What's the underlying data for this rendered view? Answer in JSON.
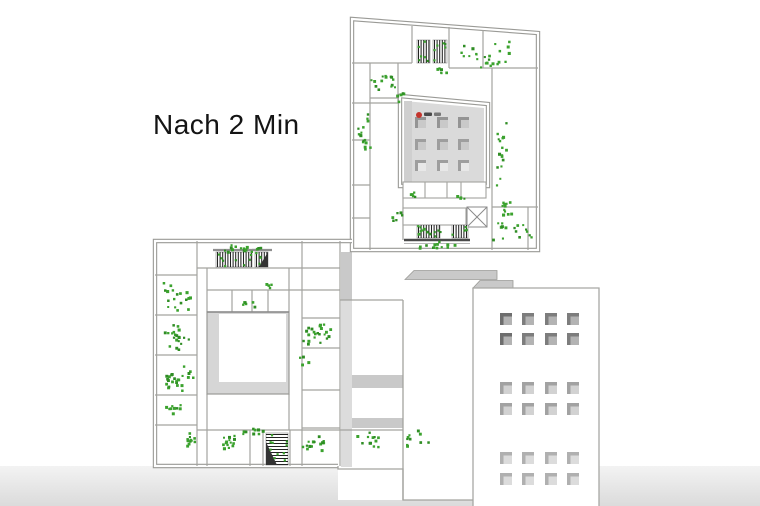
{
  "title": {
    "text": "Nach 2 Min"
  },
  "canvas": {
    "width": 760,
    "height": 506
  },
  "colors": {
    "wall": "#9a9a96",
    "wall_thin": "#a3a39f",
    "people_green": "#3ba22e",
    "people_green_dark": "#2f8d24",
    "stair_dark": "#222222",
    "roof_fill": "#dadada",
    "roof_edge": "#cfcfcf",
    "courtyard_gray": "#d6d6d6",
    "parapet": "#c9c9c9",
    "band": "#dcdcdc",
    "ground_top": "#f3f3f3",
    "ground_bottom": "#dbdbdb",
    "tower_stroke": "#a8a8a4",
    "logo_red": "#c4342c",
    "text": "#141414"
  },
  "ground": {
    "y": 466,
    "h": 40
  },
  "plan": {
    "exterior_double_walls": [
      "M352,19 L538,33 L538,250 L352,250 Z",
      "M352,241 L155,241 L155,466 L338,466"
    ],
    "exterior_single_paths": [
      "M338,466 L338,469 L403,469 L403,500 L473,500",
      "M340,300 L403,300",
      "M403,300 L403,500",
      "M340,430 L403,430"
    ],
    "white_fills": [
      {
        "x": 352,
        "y": 252,
        "w": 145,
        "h": 48
      },
      {
        "x": 352,
        "y": 300,
        "w": 51,
        "h": 167
      },
      {
        "x": 403,
        "y": 300,
        "w": 70,
        "h": 200
      },
      {
        "x": 338,
        "y": 466,
        "w": 65,
        "h": 34
      }
    ],
    "shade_bands": [
      {
        "x": 341,
        "y": 252,
        "w": 11,
        "h": 48,
        "tone": "parapet"
      },
      {
        "x": 341,
        "y": 300,
        "w": 11,
        "h": 167,
        "tone": "band"
      },
      {
        "x": 352,
        "y": 375,
        "w": 51,
        "h": 13,
        "tone": "parapet"
      },
      {
        "x": 352,
        "y": 418,
        "w": 51,
        "h": 10,
        "tone": "parapet"
      }
    ],
    "parapets": [
      "405,279.5 414,270.5 497,270.5 497,279.5",
      "473,288 480,280.5 513,280.5 513,288"
    ],
    "interior_walls": [
      "M352,63 H412",
      "M412,26 V63",
      "M449,27 V68",
      "M449,68 H538",
      "M483,30 V68",
      "M352,103 H398",
      "M398,63 V103",
      "M370,63 V250",
      "M352,140 H370",
      "M352,185 H370",
      "M352,218 H370",
      "M370,98 H400",
      "M492,68 V250",
      "M492,207 H538",
      "M528,207 V250",
      "M403,182 V240",
      "M197,241 V466",
      "M155,275 H197",
      "M155,315 H197",
      "M155,355 H197",
      "M155,395 H197",
      "M155,425 H197",
      "M197,268 H340",
      "M207,290 H340",
      "M207,268 V312",
      "M232,290 V312",
      "M252,290 V312",
      "M268,290 V312",
      "M289,268 V312",
      "M302,241 V466",
      "M340,241 V466",
      "M302,318 H340",
      "M302,348 H340",
      "M302,390 H340",
      "M302,428 H340",
      "M207,394 V466",
      "M289,394 V430",
      "M197,430 H340",
      "M250,430 V466",
      "M263,430 V466",
      "M290,430 V466"
    ]
  },
  "courtyard": {
    "x": 207,
    "y": 312,
    "w": 82,
    "h": 82,
    "inner": {
      "x": 219,
      "y": 314,
      "w": 67,
      "h": 68
    },
    "dark_top_line": {
      "x1": 207,
      "y1": 312,
      "x2": 289,
      "y2": 312
    }
  },
  "roof_block": {
    "outer_points": "400,96 488,104 488,186 400,186",
    "roof_points": "404,101 484,108 484,182 404,182",
    "edge_band": {
      "x": 404,
      "y": 101,
      "w": 8,
      "h": 81
    },
    "skylights": {
      "cols": [
        415,
        437,
        458
      ],
      "rows": [
        117,
        139,
        160
      ],
      "size": 11,
      "inner_offset": 3,
      "inner_size": 8
    }
  },
  "cells": [
    {
      "x": 403,
      "y": 182,
      "w": 83,
      "h": 16,
      "dividers_x": [
        425,
        447,
        461
      ]
    },
    {
      "x": 403,
      "y": 208,
      "w": 63,
      "h": 17,
      "dividers_x": []
    }
  ],
  "x_box": {
    "x": 467,
    "y": 207,
    "w": 20,
    "h": 20
  },
  "stairs": [
    {
      "x": 417,
      "y": 40,
      "w": 13,
      "h": 23,
      "o": "v",
      "g": 6
    },
    {
      "x": 433,
      "y": 40,
      "w": 14,
      "h": 23,
      "o": "v",
      "g": 6
    },
    {
      "x": 417,
      "y": 225,
      "w": 23,
      "h": 13,
      "o": "v",
      "g": 5
    },
    {
      "x": 452,
      "y": 225,
      "w": 16,
      "h": 13,
      "o": "v",
      "g": 4
    },
    {
      "x": 216,
      "y": 252,
      "w": 36,
      "h": 15,
      "o": "v",
      "g": 8,
      "cap": true
    },
    {
      "x": 255,
      "y": 252,
      "w": 13,
      "h": 15,
      "o": "v",
      "g": 3,
      "cap": true,
      "wedge": "r"
    },
    {
      "x": 266,
      "y": 433,
      "w": 22,
      "h": 32,
      "o": "h",
      "g": 10,
      "wedge": "l"
    }
  ],
  "stair_underlines": [
    {
      "x1": 404,
      "y1": 240,
      "x2": 470,
      "y2": 240,
      "w": 2.4,
      "color": "#4a4a4a"
    },
    {
      "x1": 404,
      "y1": 243.5,
      "x2": 470,
      "y2": 243.5,
      "w": 1,
      "color": "#b8b8b8"
    }
  ],
  "tower": {
    "x": 473,
    "y": 288,
    "w": 126,
    "h": 218,
    "window_cols": [
      500,
      522,
      545,
      567
    ],
    "window_size": 12,
    "inner_offset": 3.5,
    "inner_size": 8.5,
    "groups": [
      {
        "rows": [
          313,
          333
        ],
        "base": "#7d7d7d",
        "inner": "#b3b3b3",
        "first_col_base": "#6e6e6e"
      },
      {
        "rows": [
          382,
          403
        ],
        "base": "#a2a2a2",
        "inner": "#d2d2d2"
      },
      {
        "rows": [
          452,
          473
        ],
        "base": "#b0b0b0",
        "inner": "#dcdcdc"
      }
    ]
  },
  "people_clusters": [
    [
      384,
      80,
      14,
      16,
      11
    ],
    [
      489,
      55,
      24,
      32,
      17
    ],
    [
      437,
      68,
      6,
      12,
      5
    ],
    [
      363,
      132,
      16,
      9,
      27
    ],
    [
      399,
      93,
      6,
      7,
      8
    ],
    [
      501,
      150,
      16,
      7,
      45
    ],
    [
      505,
      223,
      20,
      14,
      26
    ],
    [
      524,
      231,
      7,
      10,
      13
    ],
    [
      432,
      244,
      14,
      28,
      6
    ],
    [
      430,
      230,
      8,
      22,
      5
    ],
    [
      396,
      214,
      6,
      6,
      10
    ],
    [
      412,
      194,
      5,
      8,
      4
    ],
    [
      459,
      196,
      4,
      8,
      3
    ],
    [
      243,
      248,
      18,
      31,
      5
    ],
    [
      270,
      284,
      4,
      10,
      4
    ],
    [
      247,
      303,
      6,
      11,
      5
    ],
    [
      176,
      296,
      18,
      15,
      17
    ],
    [
      176,
      336,
      20,
      15,
      17
    ],
    [
      178,
      378,
      24,
      16,
      19
    ],
    [
      172,
      408,
      9,
      13,
      9
    ],
    [
      317,
      332,
      22,
      20,
      14
    ],
    [
      303,
      360,
      4,
      6,
      5
    ],
    [
      187,
      439,
      13,
      9,
      8
    ],
    [
      227,
      441,
      15,
      11,
      9
    ],
    [
      252,
      430,
      9,
      16,
      5
    ],
    [
      315,
      443,
      14,
      17,
      11
    ],
    [
      370,
      440,
      12,
      16,
      13
    ],
    [
      415,
      440,
      10,
      18,
      12
    ]
  ],
  "logo": {
    "cx": 419,
    "cy": 115,
    "r": 3,
    "bars": [
      [
        424,
        112.5,
        8,
        3.5
      ],
      [
        434,
        112.5,
        7,
        3.5
      ]
    ]
  }
}
